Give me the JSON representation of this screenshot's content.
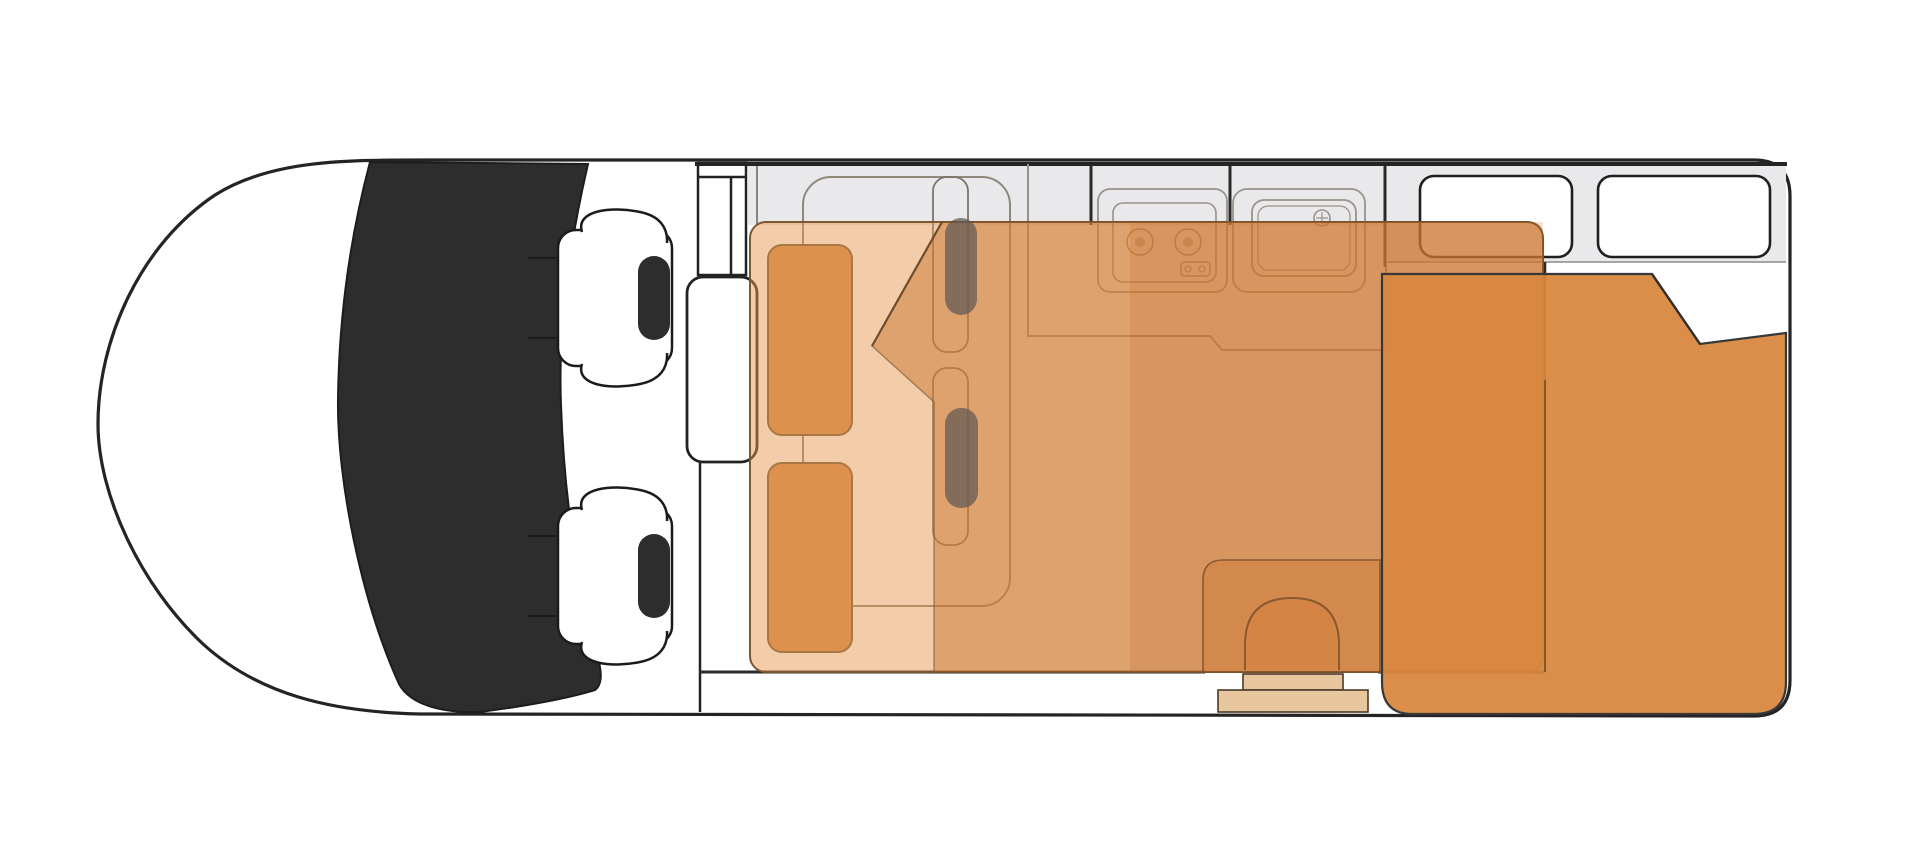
{
  "canvas": {
    "width": 1920,
    "height": 859,
    "background": "#ffffff"
  },
  "diagram": {
    "type": "campervan-floorplan-top-view",
    "parts": [
      "van-body",
      "windshield",
      "driver-seat",
      "passenger-seat",
      "cab-partition",
      "wardrobe-cabinet",
      "interior-wall-band",
      "kitchen-counter",
      "kitchen-stove",
      "kitchen-sink",
      "dinette-seat-front",
      "dinette-seat-rear",
      "travel-seat-upper",
      "travel-seat-lower",
      "front-bed-overlay",
      "front-bed-fold",
      "rear-bed-overlay",
      "rear-bed-fold",
      "entry-door-arch",
      "entry-step-upper",
      "entry-step-lower",
      "rear-window-left",
      "rear-window-right"
    ]
  },
  "colors": {
    "outline": "#242424",
    "wall": "#2a2a2a",
    "windshield": "#2d2d2d",
    "seat_black": "#2d2d2d",
    "white": "#ffffff",
    "interior_gray": "#e9e9eb",
    "gray_edge": "#8a8a8a",
    "furniture_line": "#8f887a",
    "kitchen_line": "#9a9188",
    "dinette_seat": "#d68c4e",
    "dinette_stroke": "#6f5b42",
    "overlay_front_bed": "rgba(230,150,75,0.48)",
    "overlay_front_bed_dark": "rgba(198,110,40,0.45)",
    "overlay_tone": "rgba(185,95,30,0.18)",
    "overlay_stroke": "#7d5632",
    "fold_line": "#6f4c2a",
    "rear_bed": "rgba(216,135,62,0.94)",
    "rear_bed_stroke": "#383838",
    "door_zone": "rgba(205,115,45,0.38)",
    "door_line": "rgba(125,80,42,0.85)",
    "step_fill": "#e9c79e",
    "step_stroke": "#4a3a28",
    "headrest_overlay": "rgba(95,88,80,0.72)"
  }
}
